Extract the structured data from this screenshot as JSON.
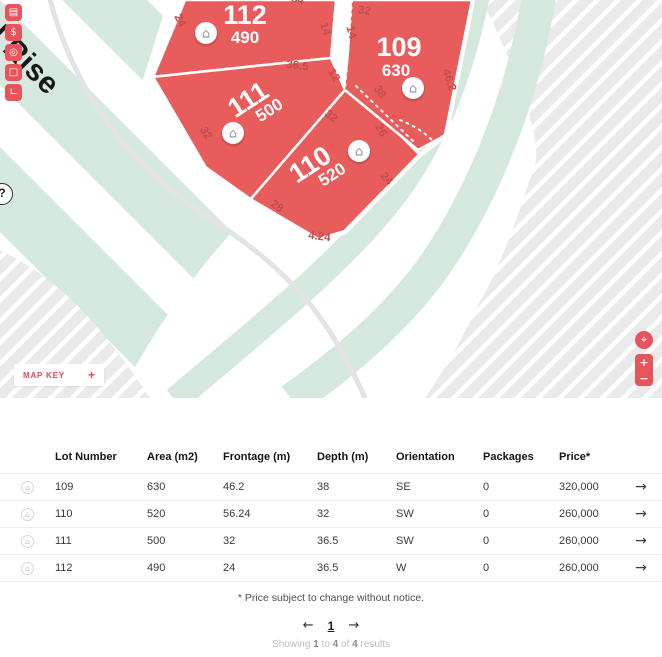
{
  "colors": {
    "accent": "#e8545c",
    "lot_fill": "#e85c5c",
    "mint": "#d4e8de",
    "hatch_base": "#eaeaea"
  },
  "map": {
    "title": "ed Rise",
    "house_glyph": "⌂",
    "help_glyph": "?",
    "sidebar": [
      {
        "name": "building-icon",
        "glyph": "▤"
      },
      {
        "name": "dollar-icon",
        "glyph": "$"
      },
      {
        "name": "compass-icon",
        "glyph": "◎"
      },
      {
        "name": "select-area-icon",
        "glyph": "□"
      },
      {
        "name": "measure-icon",
        "glyph": "∟"
      }
    ],
    "map_key": {
      "label": "MAP KEY",
      "toggle_glyph": "+"
    },
    "controls": {
      "locate_glyph": "⌖",
      "zoom_in_glyph": "+",
      "zoom_out_glyph": "−"
    },
    "lots": [
      {
        "number": "109",
        "area": "630"
      },
      {
        "number": "110",
        "area": "520"
      },
      {
        "number": "111",
        "area": "500"
      },
      {
        "number": "112",
        "area": "490"
      }
    ],
    "dims": [
      "24",
      "54",
      "32",
      "14",
      "14",
      "36.5",
      "12",
      "46.2",
      "38",
      "32",
      "26",
      "32",
      "24",
      "28",
      "4.24"
    ]
  },
  "table": {
    "row_icon_glyph": "⌂",
    "arrow_glyph": "→",
    "headers": [
      "Lot Number",
      "Area (m2)",
      "Frontage (m)",
      "Depth (m)",
      "Orientation",
      "Packages",
      "Price*"
    ],
    "rows": [
      {
        "lot": "109",
        "area": "630",
        "frontage": "46.2",
        "depth": "38",
        "orientation": "SE",
        "packages": "0",
        "price": "320,000"
      },
      {
        "lot": "110",
        "area": "520",
        "frontage": "56.24",
        "depth": "32",
        "orientation": "SW",
        "packages": "0",
        "price": "260,000"
      },
      {
        "lot": "111",
        "area": "500",
        "frontage": "32",
        "depth": "36.5",
        "orientation": "SW",
        "packages": "0",
        "price": "260,000"
      },
      {
        "lot": "112",
        "area": "490",
        "frontage": "24",
        "depth": "36.5",
        "orientation": "W",
        "packages": "0",
        "price": "260,000"
      }
    ]
  },
  "footer": {
    "note": "* Price subject to change without notice.",
    "prev_glyph": "←",
    "page": "1",
    "next_glyph": "→",
    "showing": {
      "label": "Showing",
      "from": "1",
      "to_word": "to",
      "to": "4",
      "of_word": "of",
      "total": "4",
      "results_word": "results"
    }
  }
}
